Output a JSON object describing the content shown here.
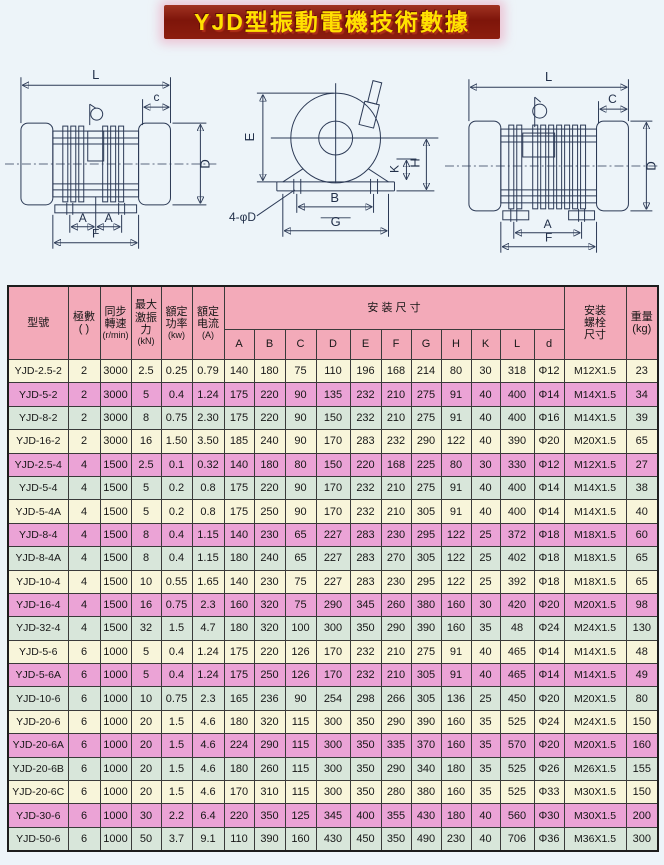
{
  "page": {
    "title": "YJD型振動電機技術數據"
  },
  "colors": {
    "page_bg": "#edf4f9",
    "title_bg": "#7e150a",
    "title_text": "#ffe100",
    "header_pink": "#f3aab9",
    "row_cream": "#f8f5da",
    "row_pink": "#eba3d6",
    "row_green": "#d8e6da"
  },
  "diagrams": {
    "left": {
      "L": "L",
      "c": "c",
      "D": "D",
      "A1": "A",
      "A2": "A",
      "F": "F"
    },
    "middle": {
      "E": "E",
      "K": "K",
      "H": "H",
      "B": "B",
      "G": "G",
      "holes": "4-φD"
    },
    "right": {
      "L": "L",
      "C": "C",
      "D": "D",
      "A": "A",
      "F": "F"
    }
  },
  "table": {
    "header": {
      "model": "型號",
      "poles_l1": "極數",
      "poles_l2": "(  )",
      "speed_l1": "同步",
      "speed_l2": "轉速",
      "speed_l3": "(r/min)",
      "force_l1": "最大",
      "force_l2": "激振",
      "force_l3": "力",
      "force_l4": "(kN)",
      "power_l1": "額定",
      "power_l2": "功率",
      "power_l3": "(kw)",
      "current_l1": "額定",
      "current_l2": "电流",
      "current_l3": "(A)",
      "install": "安 装 尺 寸",
      "bolt_l1": "安装",
      "bolt_l2": "螺栓",
      "bolt_l3": "尺寸",
      "weight_l1": "重量",
      "weight_l2": "(kg)"
    },
    "dim_letters": [
      "A",
      "B",
      "C",
      "D",
      "E",
      "F",
      "G",
      "H",
      "K",
      "L",
      "d"
    ],
    "rows": [
      [
        "YJD-2.5-2",
        "2",
        "3000",
        "2.5",
        "0.25",
        "0.79",
        "140",
        "180",
        "75",
        "110",
        "196",
        "168",
        "214",
        "80",
        "30",
        "318",
        "Φ12",
        "M12X1.5",
        "23"
      ],
      [
        "YJD-5-2",
        "2",
        "3000",
        "5",
        "0.4",
        "1.24",
        "175",
        "220",
        "90",
        "135",
        "232",
        "210",
        "275",
        "91",
        "40",
        "400",
        "Φ14",
        "M14X1.5",
        "34"
      ],
      [
        "YJD-8-2",
        "2",
        "3000",
        "8",
        "0.75",
        "2.30",
        "175",
        "220",
        "90",
        "150",
        "232",
        "210",
        "275",
        "91",
        "40",
        "400",
        "Φ16",
        "M14X1.5",
        "39"
      ],
      [
        "YJD-16-2",
        "2",
        "3000",
        "16",
        "1.50",
        "3.50",
        "185",
        "240",
        "90",
        "170",
        "283",
        "232",
        "290",
        "122",
        "40",
        "390",
        "Φ20",
        "M20X1.5",
        "65"
      ],
      [
        "YJD-2.5-4",
        "4",
        "1500",
        "2.5",
        "0.1",
        "0.32",
        "140",
        "180",
        "80",
        "150",
        "220",
        "168",
        "225",
        "80",
        "30",
        "330",
        "Φ12",
        "M12X1.5",
        "27"
      ],
      [
        "YJD-5-4",
        "4",
        "1500",
        "5",
        "0.2",
        "0.8",
        "175",
        "220",
        "90",
        "170",
        "232",
        "210",
        "275",
        "91",
        "40",
        "400",
        "Φ14",
        "M14X1.5",
        "38"
      ],
      [
        "YJD-5-4A",
        "4",
        "1500",
        "5",
        "0.2",
        "0.8",
        "175",
        "250",
        "90",
        "170",
        "232",
        "210",
        "305",
        "91",
        "40",
        "400",
        "Φ14",
        "M14X1.5",
        "40"
      ],
      [
        "YJD-8-4",
        "4",
        "1500",
        "8",
        "0.4",
        "1.15",
        "140",
        "230",
        "65",
        "227",
        "283",
        "230",
        "295",
        "122",
        "25",
        "372",
        "Φ18",
        "M18X1.5",
        "60"
      ],
      [
        "YJD-8-4A",
        "4",
        "1500",
        "8",
        "0.4",
        "1.15",
        "180",
        "240",
        "65",
        "227",
        "283",
        "270",
        "305",
        "122",
        "25",
        "402",
        "Φ18",
        "M18X1.5",
        "65"
      ],
      [
        "YJD-10-4",
        "4",
        "1500",
        "10",
        "0.55",
        "1.65",
        "140",
        "230",
        "75",
        "227",
        "283",
        "230",
        "295",
        "122",
        "25",
        "392",
        "Φ18",
        "M18X1.5",
        "65"
      ],
      [
        "YJD-16-4",
        "4",
        "1500",
        "16",
        "0.75",
        "2.3",
        "160",
        "320",
        "75",
        "290",
        "345",
        "260",
        "380",
        "160",
        "30",
        "420",
        "Φ20",
        "M20X1.5",
        "98"
      ],
      [
        "YJD-32-4",
        "4",
        "1500",
        "32",
        "1.5",
        "4.7",
        "180",
        "320",
        "100",
        "300",
        "350",
        "290",
        "390",
        "160",
        "35",
        "48",
        "Φ24",
        "M24X1.5",
        "130"
      ],
      [
        "YJD-5-6",
        "6",
        "1000",
        "5",
        "0.4",
        "1.24",
        "175",
        "220",
        "126",
        "170",
        "232",
        "210",
        "275",
        "91",
        "40",
        "465",
        "Φ14",
        "M14X1.5",
        "48"
      ],
      [
        "YJD-5-6A",
        "6",
        "1000",
        "5",
        "0.4",
        "1.24",
        "175",
        "250",
        "126",
        "170",
        "232",
        "210",
        "305",
        "91",
        "40",
        "465",
        "Φ14",
        "M14X1.5",
        "49"
      ],
      [
        "YJD-10-6",
        "6",
        "1000",
        "10",
        "0.75",
        "2.3",
        "165",
        "236",
        "90",
        "254",
        "298",
        "266",
        "305",
        "136",
        "25",
        "450",
        "Φ20",
        "M20X1.5",
        "80"
      ],
      [
        "YJD-20-6",
        "6",
        "1000",
        "20",
        "1.5",
        "4.6",
        "180",
        "320",
        "115",
        "300",
        "350",
        "290",
        "390",
        "160",
        "35",
        "525",
        "Φ24",
        "M24X1.5",
        "150"
      ],
      [
        "YJD-20-6A",
        "6",
        "1000",
        "20",
        "1.5",
        "4.6",
        "224",
        "290",
        "115",
        "300",
        "350",
        "335",
        "370",
        "160",
        "35",
        "570",
        "Φ20",
        "M20X1.5",
        "160"
      ],
      [
        "YJD-20-6B",
        "6",
        "1000",
        "20",
        "1.5",
        "4.6",
        "180",
        "260",
        "115",
        "300",
        "350",
        "290",
        "340",
        "180",
        "35",
        "525",
        "Φ26",
        "M26X1.5",
        "155"
      ],
      [
        "YJD-20-6C",
        "6",
        "1000",
        "20",
        "1.5",
        "4.6",
        "170",
        "310",
        "115",
        "300",
        "350",
        "280",
        "380",
        "160",
        "35",
        "525",
        "Φ33",
        "M30X1.5",
        "150"
      ],
      [
        "YJD-30-6",
        "6",
        "1000",
        "30",
        "2.2",
        "6.4",
        "220",
        "350",
        "125",
        "345",
        "400",
        "355",
        "430",
        "180",
        "40",
        "560",
        "Φ30",
        "M30X1.5",
        "200"
      ],
      [
        "YJD-50-6",
        "6",
        "1000",
        "50",
        "3.7",
        "9.1",
        "110",
        "390",
        "160",
        "430",
        "450",
        "350",
        "490",
        "230",
        "40",
        "706",
        "Φ36",
        "M36X1.5",
        "300"
      ]
    ]
  }
}
